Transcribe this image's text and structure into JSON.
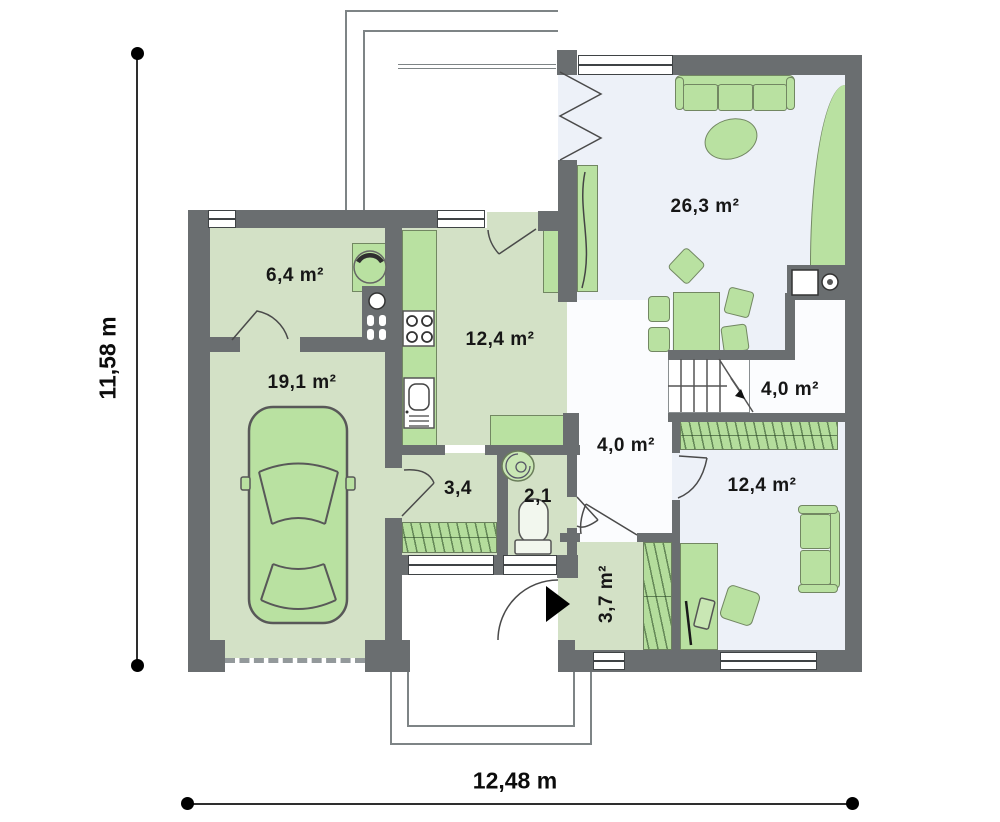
{
  "colors": {
    "wall": "#6a6e70",
    "floor_green": "#d3e1c6",
    "floor_light": "#edf1f8",
    "furniture_green": "#b9e1a1",
    "text": "#161616"
  },
  "dimensions": {
    "horizontal": "12,48 m",
    "vertical": "11,58 m"
  },
  "rooms": {
    "utility": {
      "label": "6,4 m²"
    },
    "garage": {
      "label": "19,1 m²"
    },
    "kitchen": {
      "label": "12,4 m²"
    },
    "living_room": {
      "label": "26,3 m²"
    },
    "hall_stairs": {
      "label": "4,0 m²"
    },
    "hall": {
      "label": "4,0 m²"
    },
    "corridor": {
      "label": "3,4"
    },
    "wc": {
      "label": "2,1"
    },
    "vestibule": {
      "label": "3,7 m²"
    },
    "office": {
      "label": "12,4 m²"
    }
  }
}
